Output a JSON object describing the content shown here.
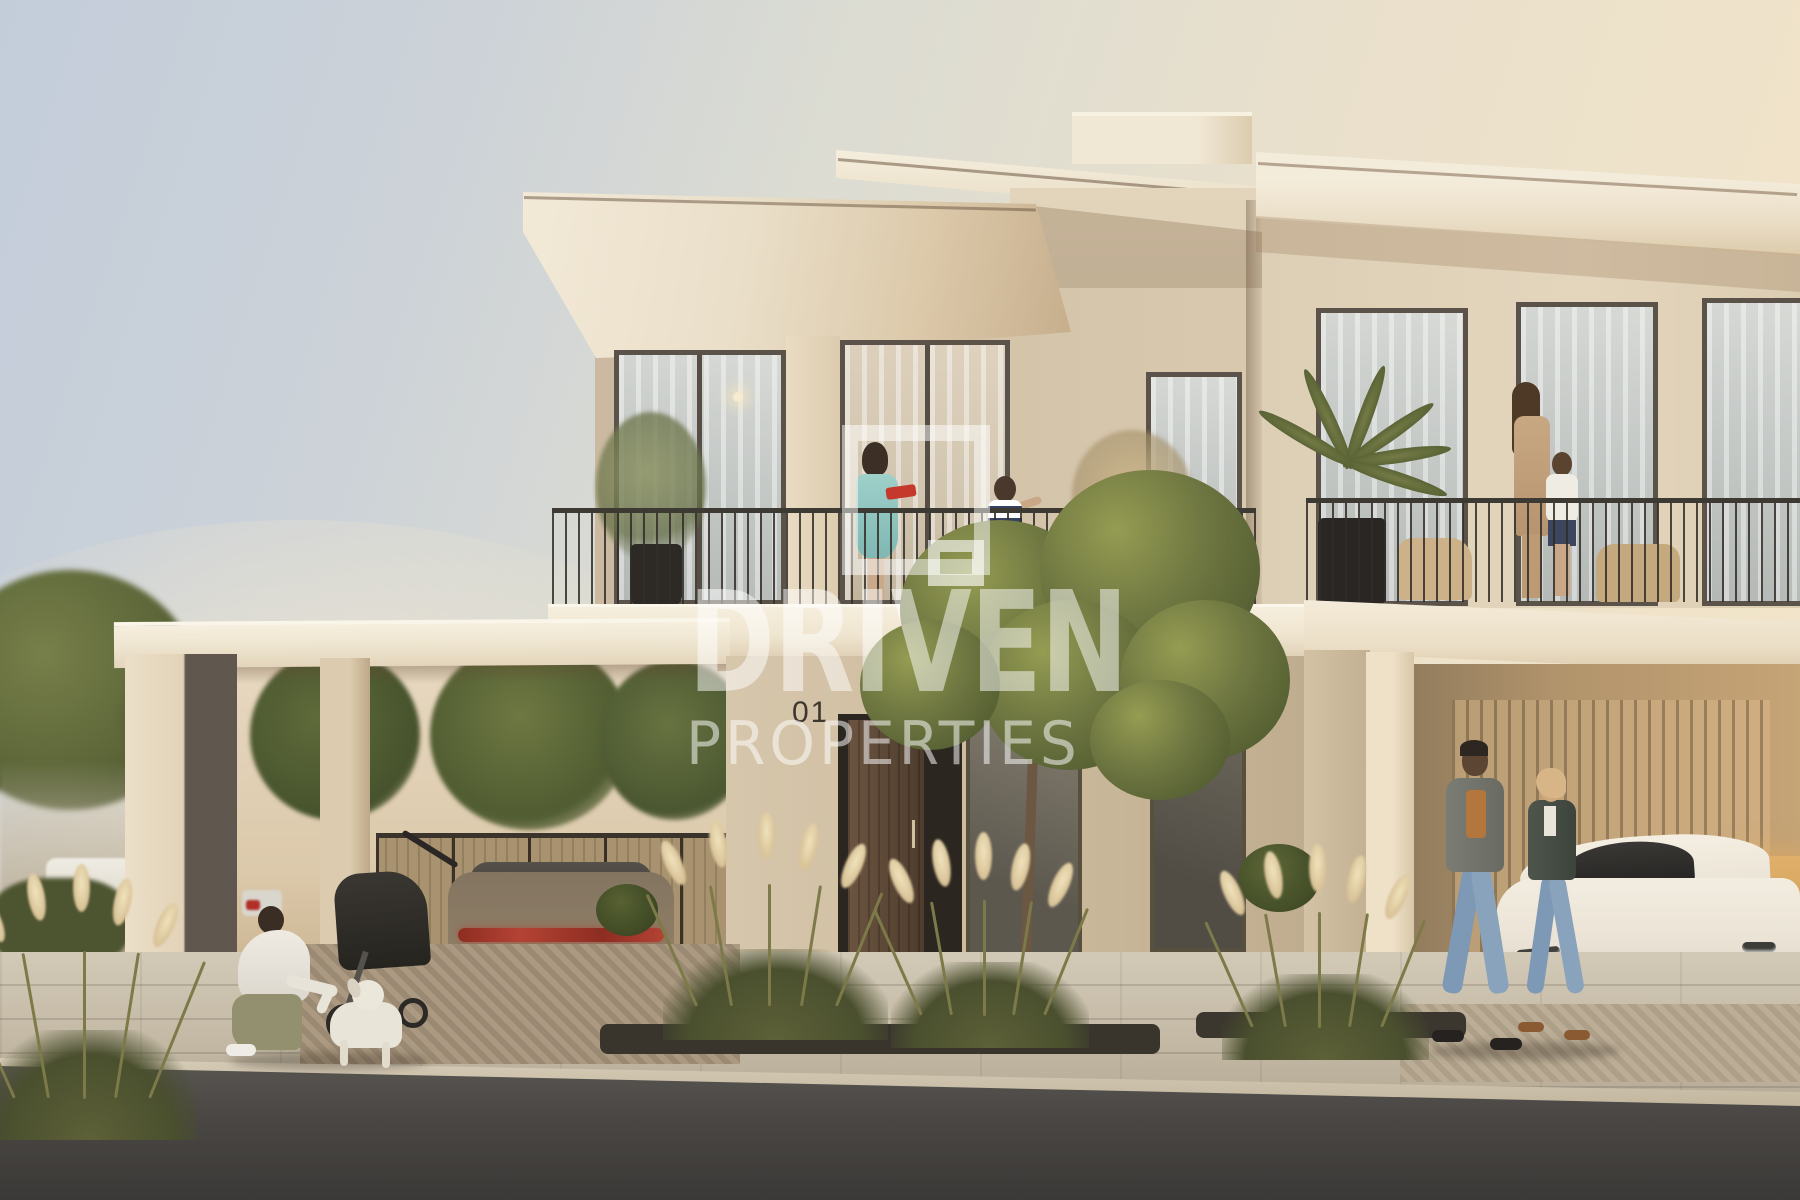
{
  "watermark": {
    "title": "DRIVEN",
    "subtitle": "PROPERTIES",
    "logo": "square-outline-logo",
    "color": "#ffffff"
  },
  "villa": {
    "house_number": "01"
  },
  "plates": {
    "audi": {
      "prefix": "C",
      "region": "DUBAI",
      "number": "39764"
    },
    "tesla": {
      "prefix": "D",
      "region": "دبي",
      "number": "786"
    }
  },
  "palette": {
    "sky_cool": "#c3cdda",
    "sky_warm": "#f2e5ca",
    "facade_cream": "#efe6d1",
    "facade_shade": "#cbbaa1",
    "foliage": "#6e7641",
    "road": "#4a4744",
    "tail_light_red": "#b44334",
    "plate_region_teal": "#0a8f7a",
    "plate_region_pink": "#c2577e"
  }
}
